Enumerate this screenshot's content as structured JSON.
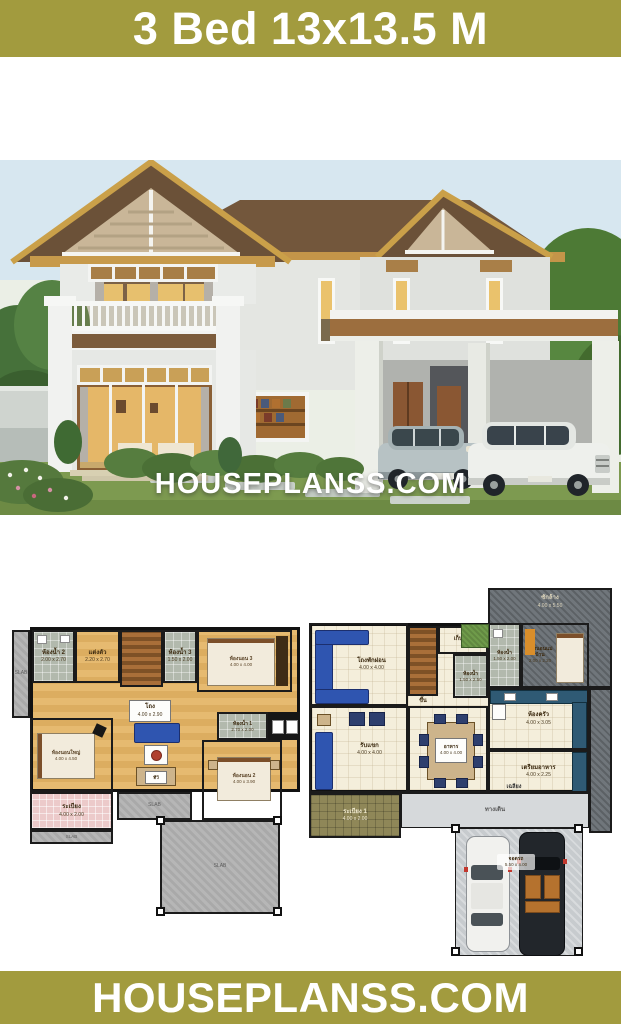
{
  "header": {
    "title": "3 Bed 13x13.5 M"
  },
  "watermark": {
    "text": "HOUSEPLANSS.COM"
  },
  "footer": {
    "text": "HOUSEPLANSS.COM"
  },
  "colors": {
    "brand_olive": "#a29b3e",
    "watermark_white": "#ffffff",
    "plan_wood_floor": "#e2b469",
    "plan_slab_gray": "#a9a9a9",
    "sofa_blue": "#2f55b0",
    "roof_brown": "#6b5138",
    "eave_gold": "#c79a4b"
  },
  "slab_label": "SLAB",
  "plans": {
    "second_floor": {
      "rooms": [
        {
          "label": "ห้องน้ำ 2",
          "dim": "2.00 x 2.70"
        },
        {
          "label": "แต่งตัว",
          "dim": "2.20 x 2.70"
        },
        {
          "label": "ห้องน้ำ 3",
          "dim": "1.50 x 2.00"
        },
        {
          "label": "ห้องนอน 3",
          "dim": "4.00 x 4.00"
        },
        {
          "label": "โถง",
          "dim": "4.00 x 2.90"
        },
        {
          "label": "ห้องนอนใหญ่",
          "dim": "4.00 x 4.50"
        },
        {
          "label": "ห้องน้ำ 1",
          "dim": "2.70 x 2.00"
        },
        {
          "label": "ห้องนอน 2",
          "dim": "4.00 x 3.90"
        },
        {
          "label": "ระเบียง",
          "dim": "4.00 x 2.00"
        },
        {
          "label": "ทีวี",
          "dim": ""
        }
      ]
    },
    "first_floor": {
      "rooms": [
        {
          "label": "ซักล้าง",
          "dim": "4.00 x 5.50"
        },
        {
          "label": "โถงพักผ่อน",
          "dim": "4.00 x 4.00"
        },
        {
          "label": "เก็บของ",
          "dim": ""
        },
        {
          "label": "ขึ้น",
          "dim": ""
        },
        {
          "label": "ห้องน้ำ",
          "dim": "1.50 x 2.50"
        },
        {
          "label": "ห้องน้ำ",
          "dim": "1.50 x 2.00"
        },
        {
          "label": "ห้องนอนแม่บ้าน",
          "dim": "2.00 x 2.20"
        },
        {
          "label": "ห้องครัว",
          "dim": "4.00 x 3.05"
        },
        {
          "label": "รับแขก",
          "dim": "4.00 x 4.00"
        },
        {
          "label": "อาหาร",
          "dim": "4.00 x 4.00"
        },
        {
          "label": "เตรียมอาหาร",
          "dim": "4.00 x 2.25"
        },
        {
          "label": "เฉลียง",
          "dim": ""
        },
        {
          "label": "ระเบียง 1",
          "dim": "4.00 x 2.00"
        },
        {
          "label": "ทางเดิน",
          "dim": ""
        },
        {
          "label": "จอดรถ",
          "dim": "5.50 x 4.00"
        }
      ]
    }
  }
}
